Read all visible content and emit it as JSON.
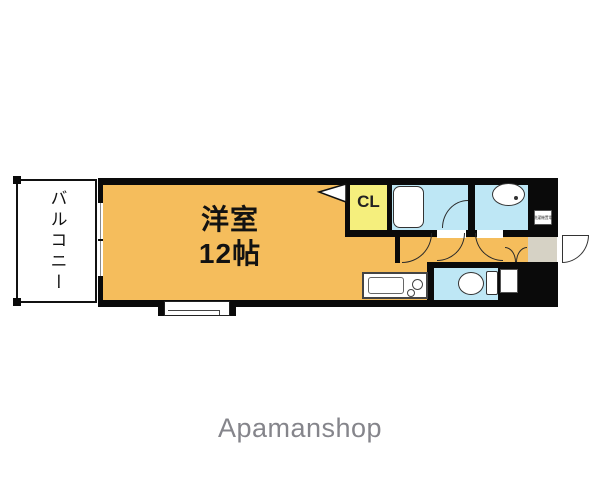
{
  "floor_plan": {
    "balcony_label": "バルコニー",
    "main_room": {
      "name": "洋室",
      "size": "12帖"
    },
    "closet_label": "CL",
    "washer_box_label": "洗濯機置場",
    "colors": {
      "room_orange": "#F5BD5C",
      "closet_yellow": "#F5EF7D",
      "wet_area_blue": "#BEE7F5",
      "entry_gray": "#D6D2C5",
      "wall_black": "#0A0A0A",
      "brand_gray": "#85858B"
    }
  },
  "footer": {
    "brand": "Apamanshop"
  }
}
